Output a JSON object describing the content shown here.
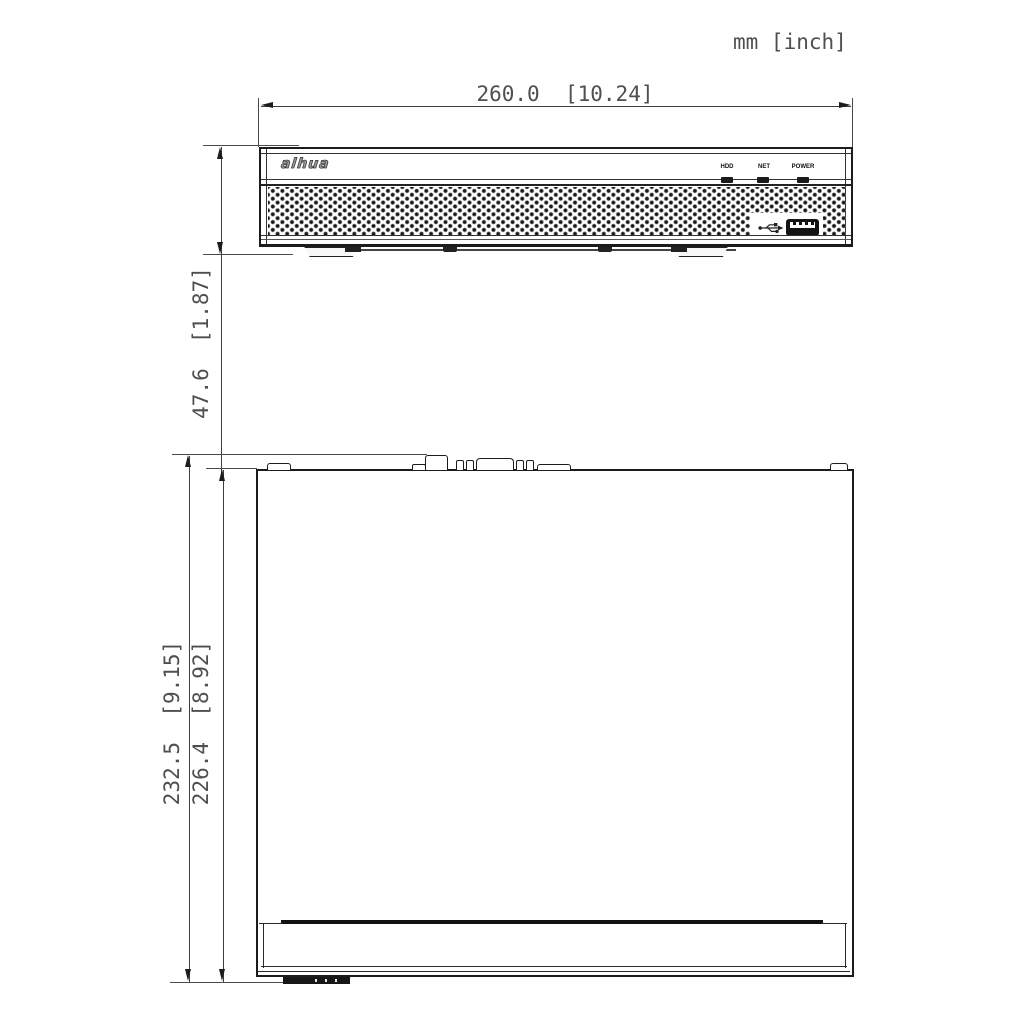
{
  "drawing": {
    "units_label": "mm [inch]",
    "front_view": {
      "view_name": "front-view",
      "width_dim_label": "260.0  [10.24]",
      "height_dim_label": "47.6  [1.87]",
      "brand_logo": "alhua",
      "leds": [
        {
          "label": "HDD"
        },
        {
          "label": "NET"
        },
        {
          "label": "POWER"
        }
      ],
      "icons": {
        "usb_icon": "usb-trident-symbol",
        "usb_port": "usb-type-a-port"
      }
    },
    "top_view": {
      "view_name": "top-view",
      "outer_height_dim_label": "232.5  [9.15]",
      "inner_height_dim_label": "226.4  [8.92]"
    },
    "colors": {
      "drawing_line": "#1c1c1c",
      "dimension_line": "#3d3d3d",
      "dimension_text": "#4f4f4f"
    }
  }
}
